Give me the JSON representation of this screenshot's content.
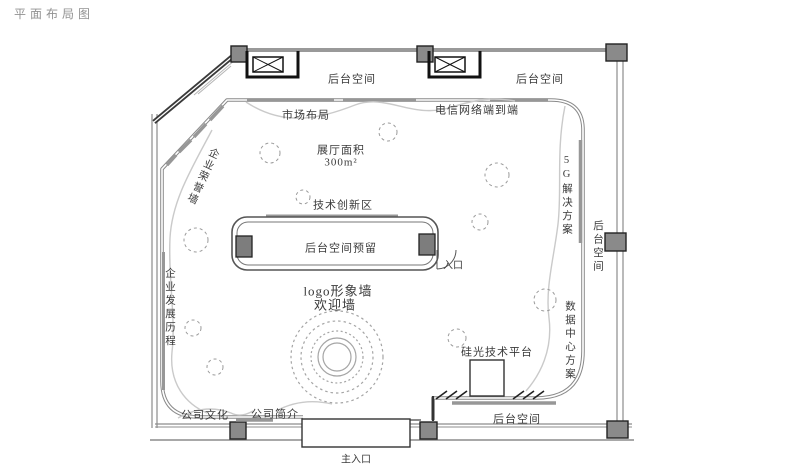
{
  "title": "平面布局图",
  "plan": {
    "labels": {
      "backstage_top_left": "后台空间",
      "backstage_top_right": "后台空间",
      "telecom_wall": "电信网络端到端",
      "market_layout": "市场布局",
      "hall_area_title": "展厅面积",
      "hall_area_value": "300m²",
      "honor_wall": "企业荣誉墙",
      "tech_innovation": "技术创新区",
      "backstage_reserved": "后台空间预留",
      "entrance": "入口",
      "logo_wall": "logo形象墙",
      "welcome_wall": "欢迎墙",
      "development_history": "企业发展历程",
      "solution_5g": "5G解决方案",
      "backstage_right": "后台空间",
      "datacenter_solution": "数据中心方案",
      "silicon_platform": "硅光技术平台",
      "company_culture": "公司文化",
      "company_profile": "公司简介",
      "backstage_bottom": "后台空间",
      "main_entrance": "主入口"
    },
    "colors": {
      "wall_gray": "#999999",
      "wall_dark": "#3a3a3a",
      "column_fill": "#8a8a8a",
      "dashed_circle": "#9a9a9a",
      "circulation_path": "#cacaca",
      "label_text": "#3a3a3a",
      "title_text": "#929292"
    }
  }
}
